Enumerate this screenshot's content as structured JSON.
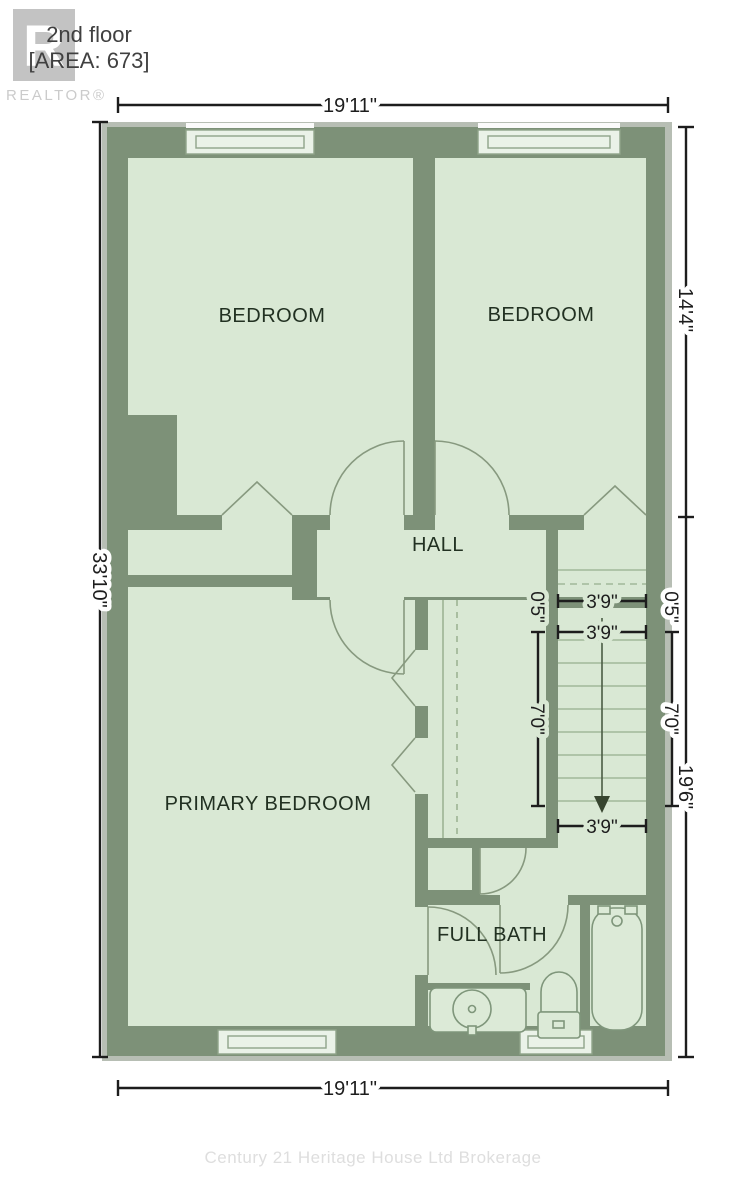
{
  "header": {
    "title": "2nd floor",
    "area_label": "[AREA: 673]",
    "logo_letter": "R",
    "logo_brand": "REALTOR®"
  },
  "plan": {
    "rooms": {
      "bedroom_left": "BEDROOM",
      "bedroom_right": "BEDROOM",
      "hall": "HALL",
      "primary_bedroom": "PRIMARY BEDROOM",
      "full_bath": "FULL BATH"
    },
    "dimensions": {
      "width_top": "19'11\"",
      "width_bottom": "19'11\"",
      "height_left": "33'10\"",
      "height_right_upper": "14'4\"",
      "height_right_lower": "19'6\"",
      "stair_width_upper": "3'9\"",
      "stair_width_mid": "3'9\"",
      "stair_width_lower": "3'9\"",
      "stair_run_left": "7'0\"",
      "stair_run_right": "7'0\"",
      "stair_offset_left": "0'5\"",
      "stair_offset_right": "0'5\""
    }
  },
  "footer": {
    "watermark": "Century 21 Heritage House Ltd Brokerage"
  },
  "colors": {
    "wall": "#7d9178",
    "floor": "#d9e8d4",
    "underlay": "#b7beb4",
    "dimension": "#1d1d1d",
    "room_label": "#223122",
    "fixture_line": "#7f967b",
    "logo_gray": "#c3c3c3",
    "watermark_gray": "#dedede"
  }
}
